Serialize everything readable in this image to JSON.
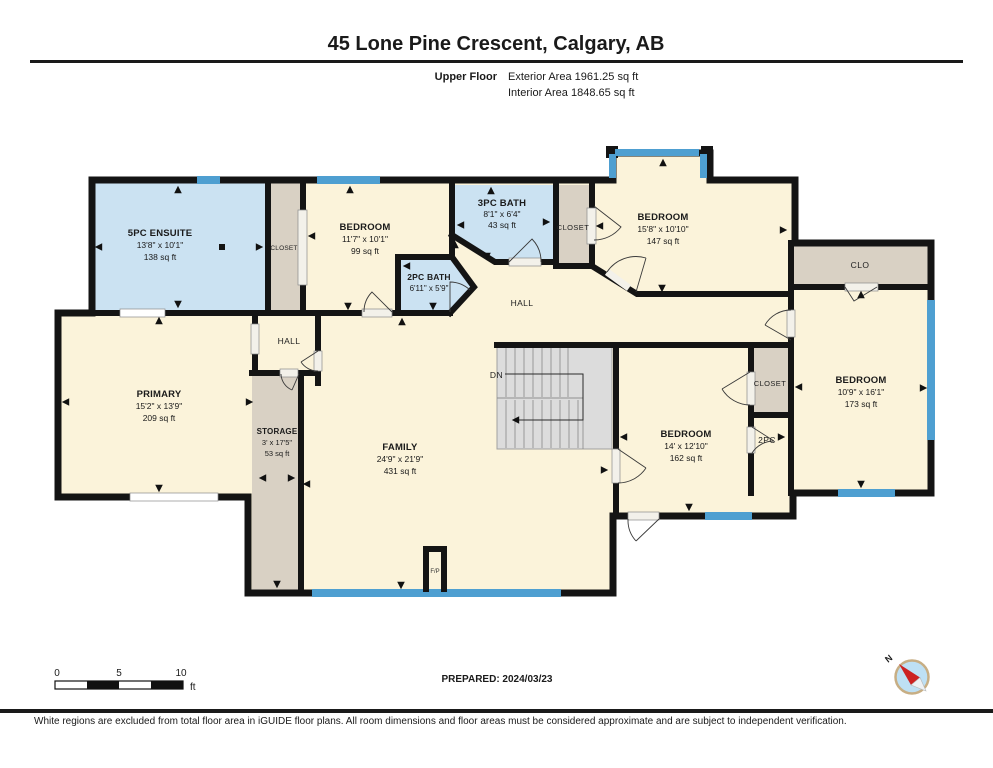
{
  "header": {
    "title": "45 Lone Pine Crescent, Calgary, AB",
    "floor_label": "Upper Floor",
    "exterior_area": "Exterior Area 1961.25 sq ft",
    "interior_area": "Interior Area 1848.65 sq ft"
  },
  "rooms": [
    {
      "name": "5PC ENSUITE",
      "dims": "13'8\" x 10'1\"",
      "area": "138 sq ft"
    },
    {
      "name": "BEDROOM",
      "dims": "11'7\" x 10'1\"",
      "area": "99 sq ft"
    },
    {
      "name": "3PC BATH",
      "dims": "8'1\" x 6'4\"",
      "area": "43 sq ft"
    },
    {
      "name": "2PC BATH",
      "dims": "6'11\" x 5'9\"",
      "area": ""
    },
    {
      "name": "BEDROOM",
      "dims": "15'8\" x 10'10\"",
      "area": "147 sq ft"
    },
    {
      "name": "BEDROOM",
      "dims": "10'9\" x 16'1\"",
      "area": "173 sq ft"
    },
    {
      "name": "BEDROOM",
      "dims": "14' x 12'10\"",
      "area": "162 sq ft"
    },
    {
      "name": "PRIMARY",
      "dims": "15'2\" x 13'9\"",
      "area": "209 sq ft"
    },
    {
      "name": "STORAGE",
      "dims": "3' x 17'5\"",
      "area": "53 sq ft"
    },
    {
      "name": "FAMILY",
      "dims": "24'9\" x 21'9\"",
      "area": "431 sq ft"
    }
  ],
  "labels": {
    "closet1": "CLOSET",
    "closet2": "CLOSET",
    "closet3": "CLOSET",
    "clo": "CLO",
    "hall_small": "HALL",
    "hall_center": "HALL",
    "two_pc": "2PC",
    "down": "DN",
    "fireplace": "F/P"
  },
  "scale_bar": {
    "tick0": "0",
    "tick5": "5",
    "tick10": "10",
    "unit": "ft"
  },
  "compass": {
    "north_label": "N"
  },
  "footer": {
    "prepared": "PREPARED: 2024/03/23",
    "disclaimer": "White regions are excluded from total floor area in iGUIDE floor plans. All room dimensions and floor areas must be considered approximate and are subject to independent verification."
  },
  "colors": {
    "room_fill": "#FBF3DA",
    "wet_room_fill": "#CBE2F2",
    "closet_fill": "#D9D1C4",
    "window": "#4E9FD1",
    "wall": "#141414",
    "stairs_fill": "#DCDCDC"
  }
}
